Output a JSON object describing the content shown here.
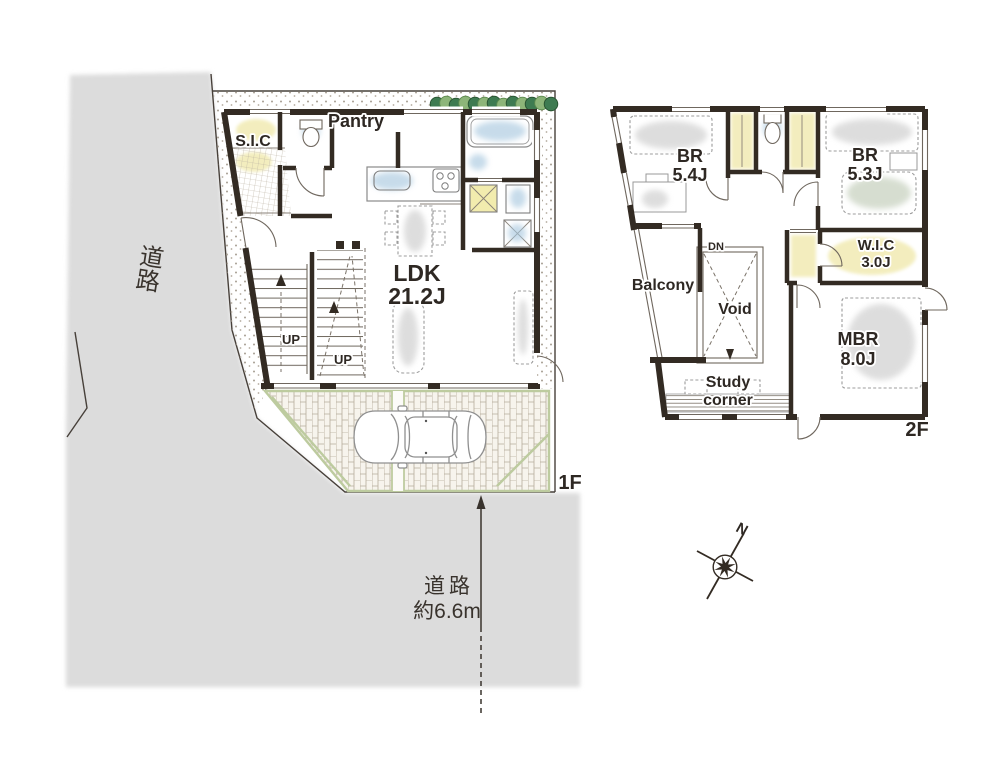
{
  "site": {
    "road_left_label": "道路",
    "road_bottom_label_line1": "道路",
    "road_bottom_label_line2": "約6.6m"
  },
  "floor1": {
    "floor_label": "1F",
    "sic_label": "S.I.C",
    "pantry_label": "Pantry",
    "ldk_label": "LDK",
    "ldk_size": "21.2J",
    "stairs_up_label_1": "UP",
    "stairs_up_label_2": "UP"
  },
  "floor2": {
    "floor_label": "2F",
    "bedroom1_label": "BR",
    "bedroom1_size": "5.4J",
    "bedroom2_label": "BR",
    "bedroom2_size": "5.3J",
    "wic_label": "W.I.C",
    "wic_size": "3.0J",
    "balcony_label": "Balcony",
    "void_label": "Void",
    "stairs_down_label": "DN",
    "mbr_label": "MBR",
    "mbr_size": "8.0J",
    "study_label_line1": "Study",
    "study_label_line2": "corner"
  },
  "compass": {
    "north_label": "N"
  },
  "colors": {
    "wall": "#332b23",
    "road_fill": "#dcdcdc",
    "boundary_line": "#47403a",
    "water_accent": "#a5c6de",
    "closet_yellow": "#f3edbb",
    "hedge_green_dark": "#3e7b51",
    "hedge_green_light": "#8db579",
    "garage_edge_green": "#bdcb9f",
    "paving_line": "#b6ac9b",
    "label_text": "#2e2823"
  }
}
